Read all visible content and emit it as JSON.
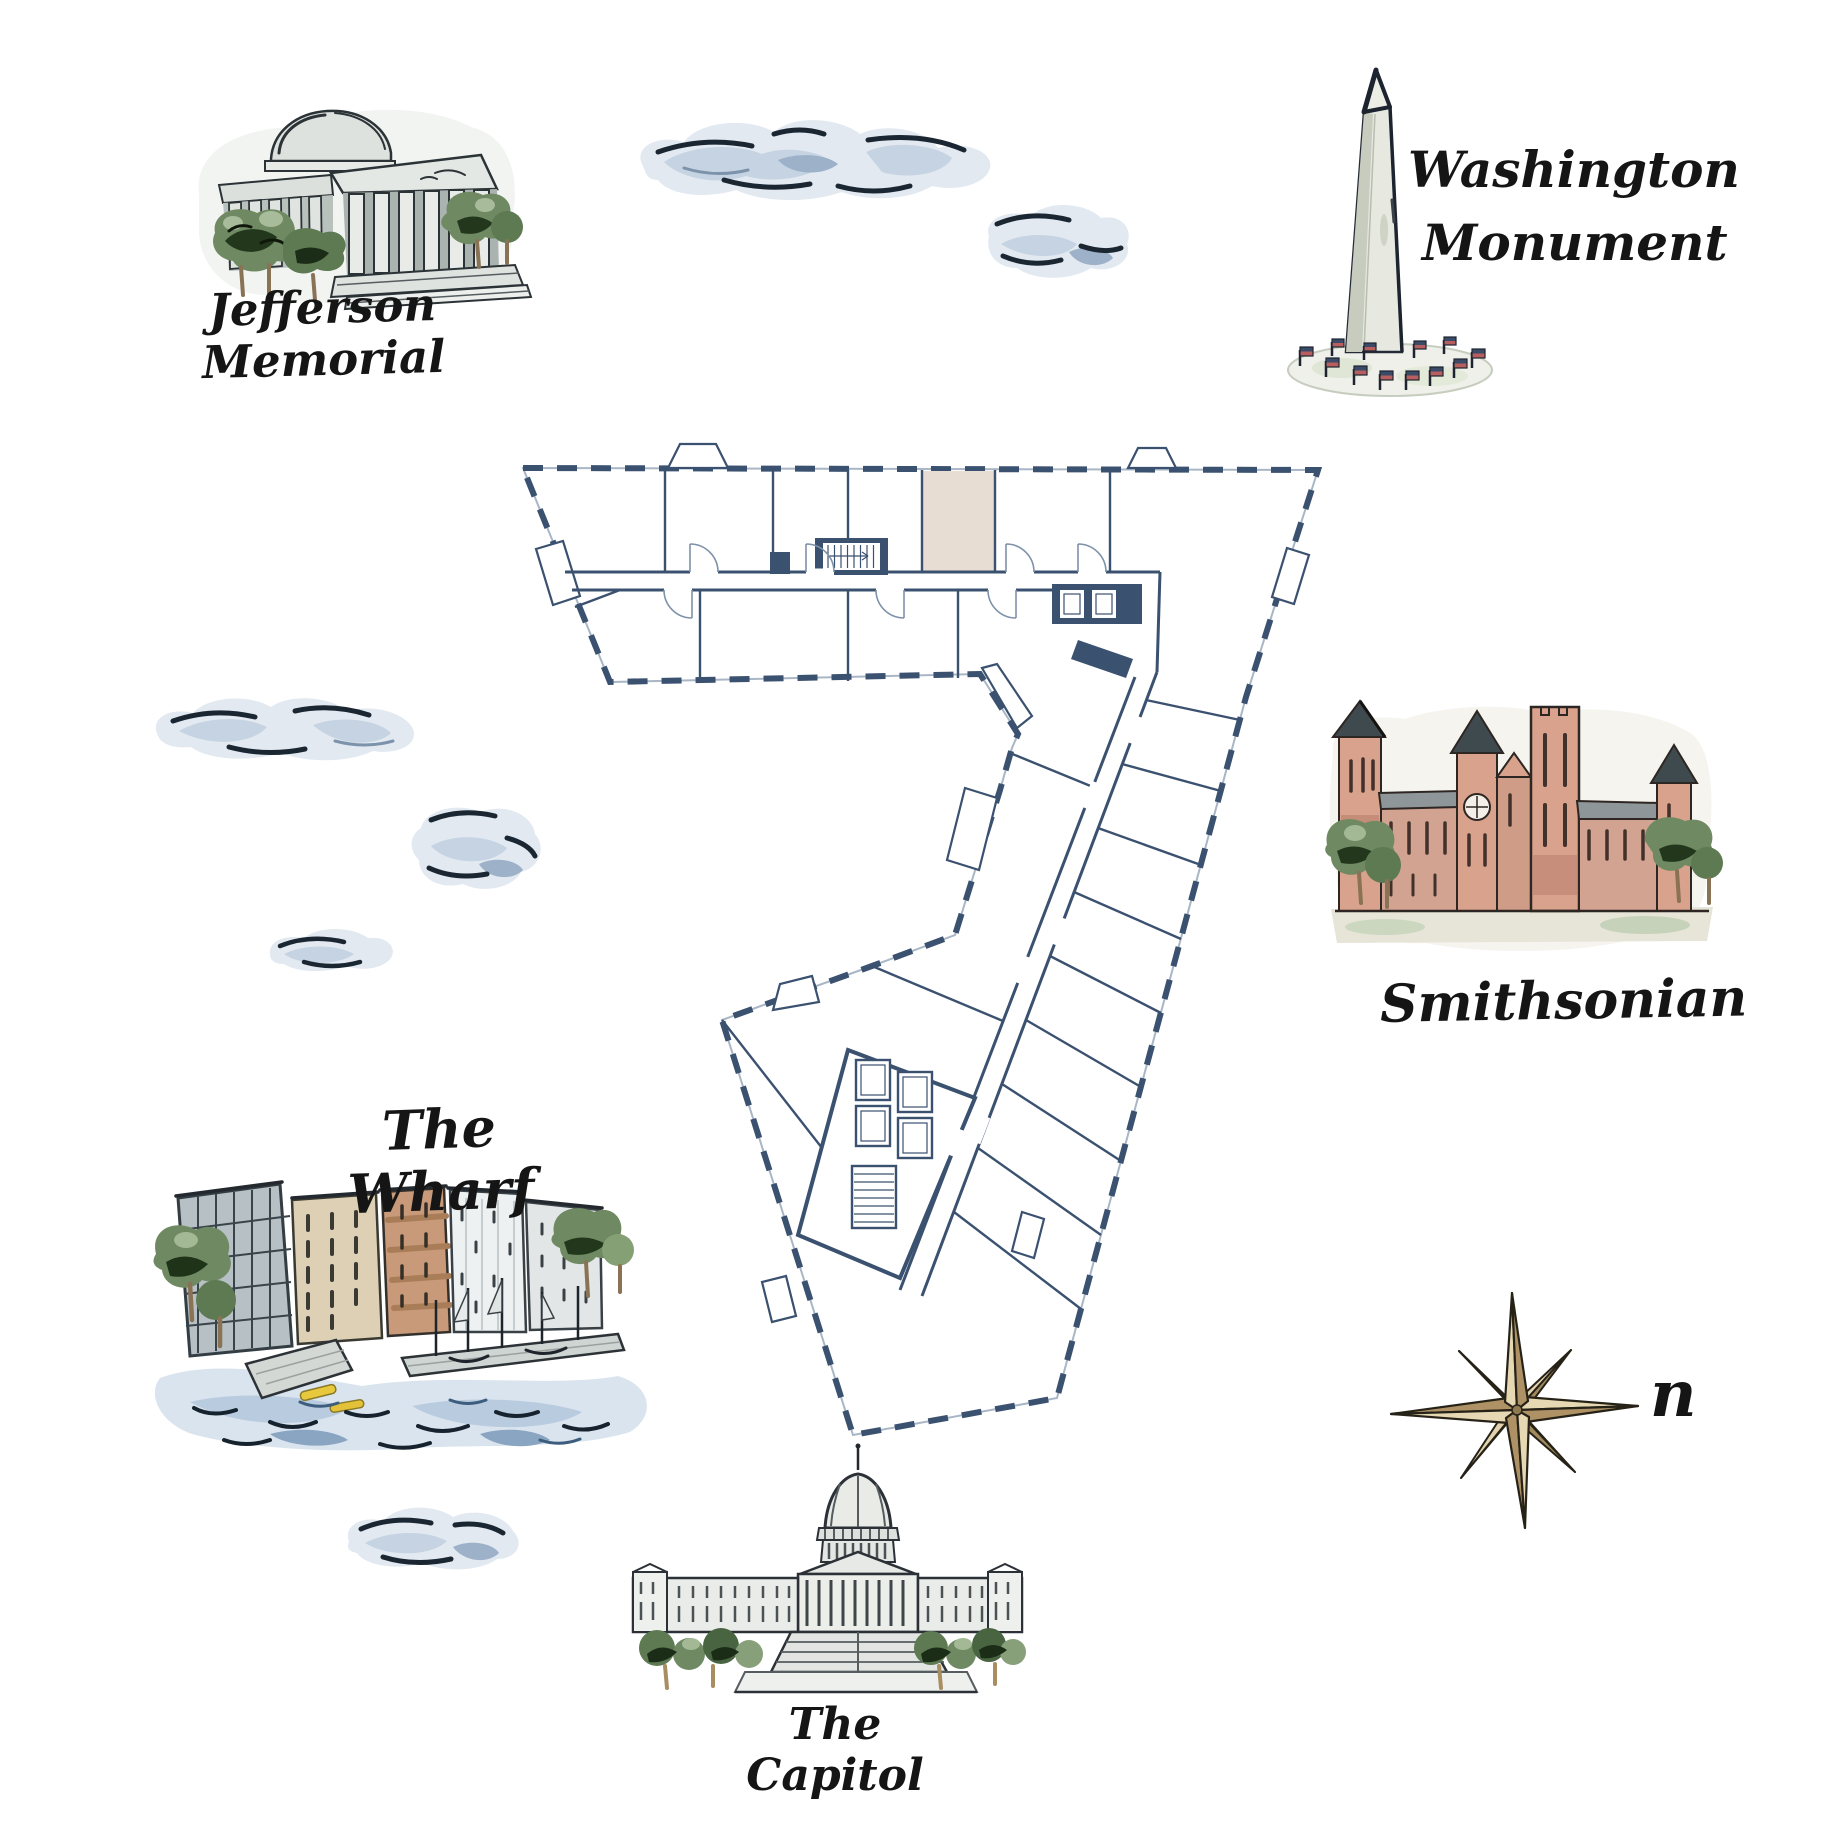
{
  "title": "Illustrated Washington DC map with building floor plan",
  "labels": {
    "jefferson_memorial": "Jefferson Memorial",
    "washington_monument_line1": "Washington",
    "washington_monument_line2": "Monument",
    "smithsonian": "Smithsonian",
    "the_wharf": "The Wharf",
    "the_capitol": "The Capitol",
    "compass_north": "n"
  },
  "landmarks": [
    {
      "id": "jefferson-memorial",
      "label": "Jefferson Memorial",
      "position": "top-left"
    },
    {
      "id": "washington-monument",
      "label": "Washington Monument",
      "position": "top-right"
    },
    {
      "id": "smithsonian",
      "label": "Smithsonian",
      "position": "right"
    },
    {
      "id": "the-wharf",
      "label": "The Wharf",
      "position": "left"
    },
    {
      "id": "the-capitol",
      "label": "The Capitol",
      "position": "bottom-center"
    }
  ],
  "floor_plan": {
    "shape": "numeral-7 shaped office floor plate",
    "highlighted_room_fill": "#e7ddd3",
    "wall_color": "#3b5170"
  },
  "palette": {
    "wall_navy": "#3b5170",
    "light_line": "#a9b6c6",
    "highlight_beige": "#e7ddd3",
    "cloud_light": "#e2e9f1",
    "cloud_mid": "#c5d3e2",
    "cloud_deep": "#9db1c9",
    "ink": "#1a2632",
    "tree_green": "#6f8a63",
    "tree_dark": "#22371c",
    "salmon": "#d8a28d",
    "roof_gray": "#8f9699",
    "compass_light": "#e6d8b2",
    "compass_dark": "#ae9266",
    "flag_navy": "#3b4a66",
    "flag_red": "#b75f5f",
    "water_blue": "#dae4ee",
    "kayak_yellow": "#e8c93e"
  }
}
